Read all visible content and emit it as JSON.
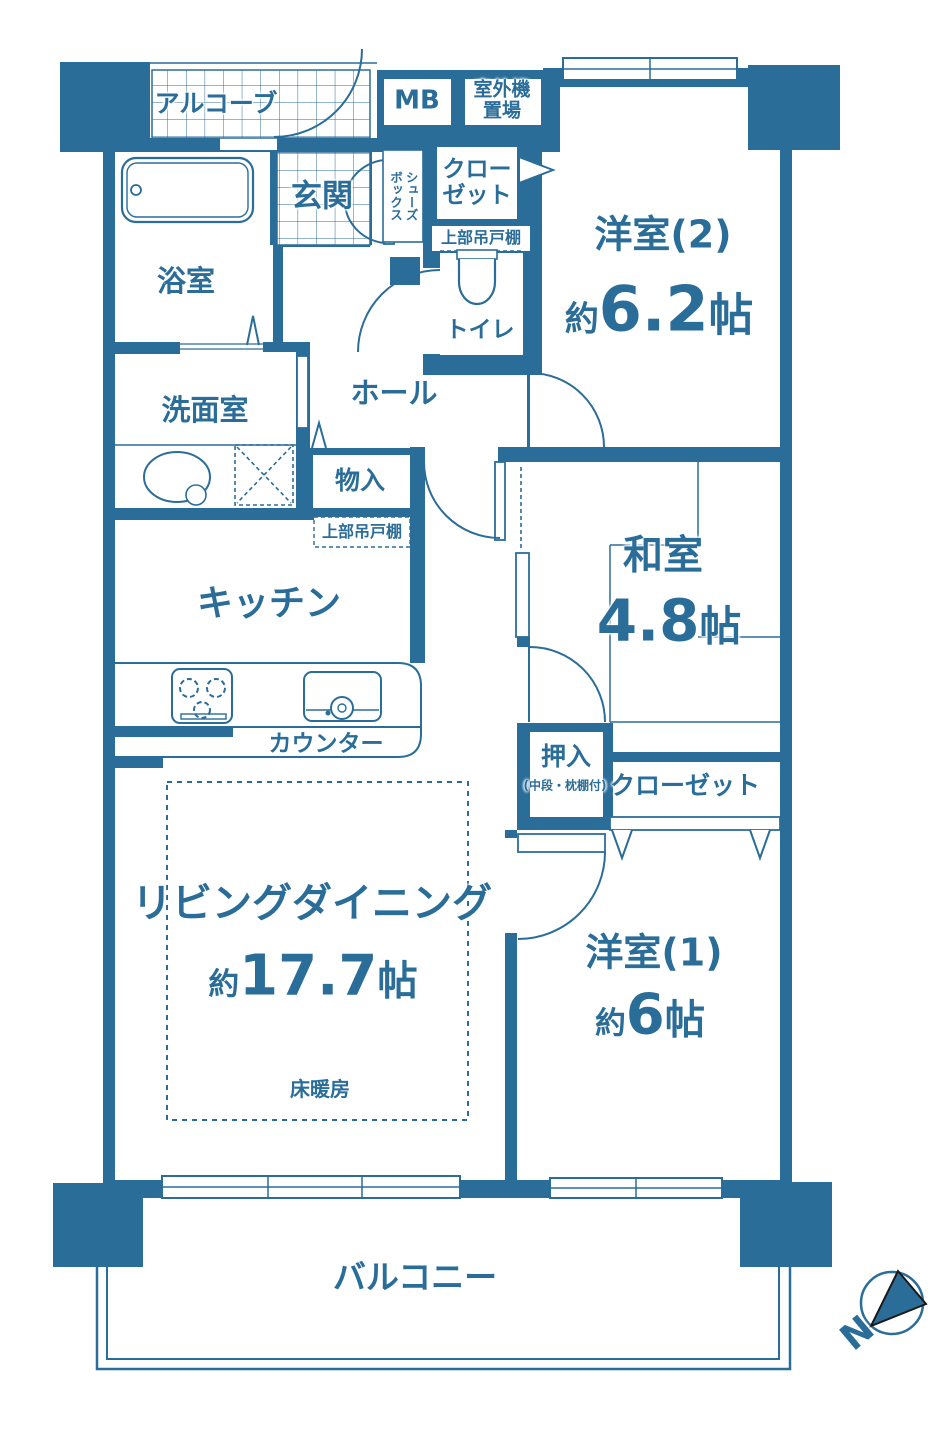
{
  "palette": {
    "blue": "#2b6d99",
    "white": "#ffffff",
    "compass_stroke": "#1a1a1a"
  },
  "rooms": {
    "alcove": {
      "label": "アルコーブ"
    },
    "mb": {
      "label": "MB"
    },
    "outdoor_unit": {
      "line1": "室外機",
      "line2": "置場"
    },
    "genkan": {
      "label": "玄関"
    },
    "shoes_box": {
      "line1": "シューズ",
      "line2": "ボックス"
    },
    "closet_north": {
      "line1": "クロー",
      "line2": "ゼット"
    },
    "upper_cabinet_toilet": {
      "label": "上部吊戸棚"
    },
    "toilet": {
      "label": "トイレ"
    },
    "bathroom": {
      "label": "浴室"
    },
    "washroom": {
      "label": "洗面室"
    },
    "hall": {
      "label": "ホール"
    },
    "storage": {
      "label": "物入"
    },
    "upper_cabinet_kitchen": {
      "label": "上部吊戸棚"
    },
    "kitchen": {
      "label": "キッチン"
    },
    "counter": {
      "label": "カウンター"
    },
    "yoshitsu2": {
      "name": "洋室(2)",
      "size_prefix": "約",
      "size_value": "6.2",
      "size_unit": "帖"
    },
    "washitsu": {
      "name": "和室",
      "size_value": "4.8",
      "size_unit": "帖"
    },
    "oshiire": {
      "name": "押入",
      "note": "(中段・枕棚付)"
    },
    "closet_south": {
      "label": "クローゼット"
    },
    "living": {
      "name": "リビングダイニング",
      "size_prefix": "約",
      "size_value": "17.7",
      "size_unit": "帖",
      "floor_heating": "床暖房"
    },
    "yoshitsu1": {
      "name": "洋室(1)",
      "size_prefix": "約",
      "size_value": "6",
      "size_unit": "帖"
    },
    "balcony": {
      "label": "バルコニー"
    }
  },
  "compass": {
    "label": "N"
  }
}
